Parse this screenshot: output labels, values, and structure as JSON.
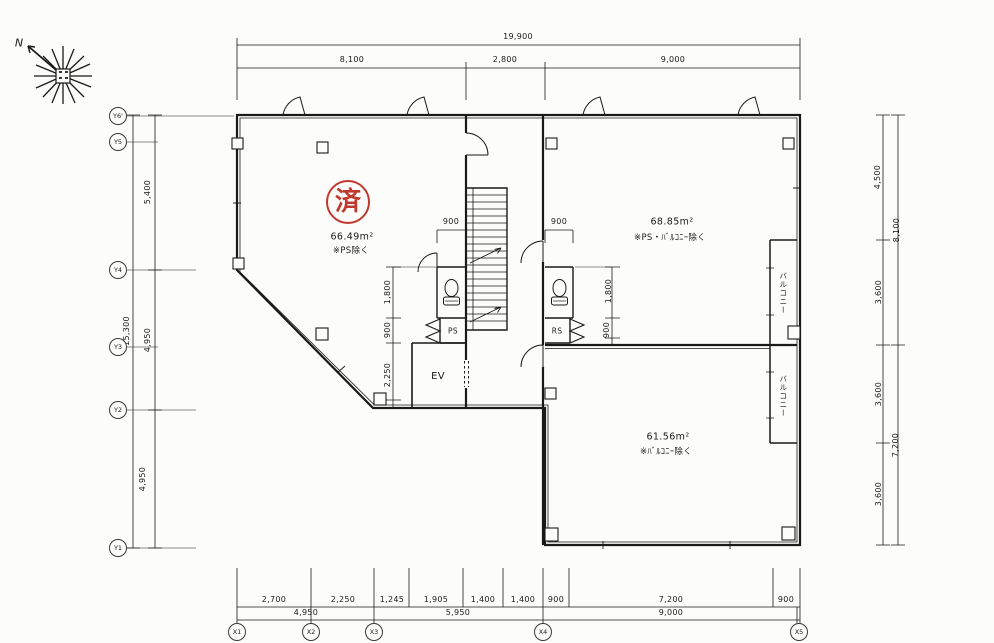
{
  "compass": {
    "north_label": "N"
  },
  "stamp": {
    "text": "済"
  },
  "rooms": {
    "left": {
      "area": "66.49m²",
      "note": "※PS除く"
    },
    "upper_right": {
      "area": "68.85m²",
      "note": "※PS・ﾊﾞﾙｺﾆｰ除く"
    },
    "lower_right": {
      "area": "61.56m²",
      "note": "※ﾊﾞﾙｺﾆｰ除く"
    }
  },
  "core": {
    "elevator_label": "EV",
    "pipe_space_left_label": "PS",
    "pipe_space_right_label": "RS"
  },
  "balcony": {
    "label": "バルコニー"
  },
  "dims": {
    "top": {
      "total": "19,900",
      "segments": [
        "8,100",
        "2,800",
        "9,000"
      ]
    },
    "bottom": {
      "row1": [
        "2,700",
        "2,250",
        "1,245",
        "1,905",
        "1,400",
        "1,400",
        "900",
        "7,200",
        "900"
      ],
      "row2": [
        "4,950",
        "5,950",
        "9,000"
      ]
    },
    "left": {
      "total": "15,300",
      "segments": [
        "5,400",
        "4,950",
        "4,950"
      ]
    },
    "right": {
      "segments": [
        "4,500",
        "3,600",
        "3,600",
        "3,600"
      ],
      "outer": [
        "8,100",
        "7,200"
      ]
    },
    "core_left": [
      "1,800",
      "900",
      "2,250"
    ],
    "core_right": [
      "1,800",
      "900"
    ],
    "stair_left": "900",
    "stair_right": "900"
  },
  "grid": {
    "x": [
      "X1",
      "X2",
      "X3",
      "X4",
      "X5"
    ],
    "y": [
      "Y6'",
      "Y5",
      "Y4",
      "Y3",
      "Y2",
      "Y1"
    ]
  }
}
